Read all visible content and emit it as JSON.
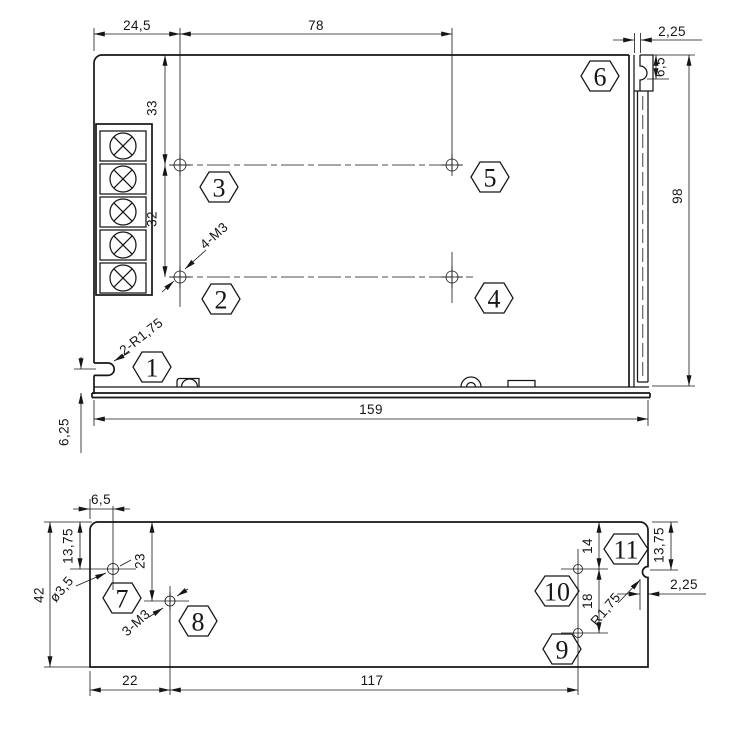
{
  "colors": {
    "background": "#ffffff",
    "line": "#161616"
  },
  "top_view": {
    "dims": {
      "hole_offset_x": "24,5",
      "hole_span_x": "78",
      "rail_slot_width": "2,25",
      "rail_slot_depth": "6,5",
      "hole_row_top": "33",
      "hole_row_spacing": "32",
      "body_height": "98",
      "body_length": "159",
      "notch_offset": "6,25"
    },
    "labels": {
      "mounting_holes": "4-M3",
      "side_notches": "2-R1,75"
    },
    "balloons": [
      "1",
      "2",
      "3",
      "4",
      "5",
      "6"
    ]
  },
  "bottom_view": {
    "dims": {
      "hole7_offset_x": "6,5",
      "hole7_offset_y": "13,75",
      "hole8_offset_y": "23",
      "body_height": "42",
      "hole8_offset_x": "22",
      "hole_span_x": "117",
      "hole10_offset_y": "14",
      "hole_spacing_y": "18",
      "notch_offset_y": "13,75",
      "notch_depth": "2,25"
    },
    "labels": {
      "hole_diameter": "ø3,5",
      "mounting_holes": "3-M3",
      "notch_radius": "R1,75"
    },
    "balloons": [
      "7",
      "8",
      "9",
      "10",
      "11"
    ]
  }
}
